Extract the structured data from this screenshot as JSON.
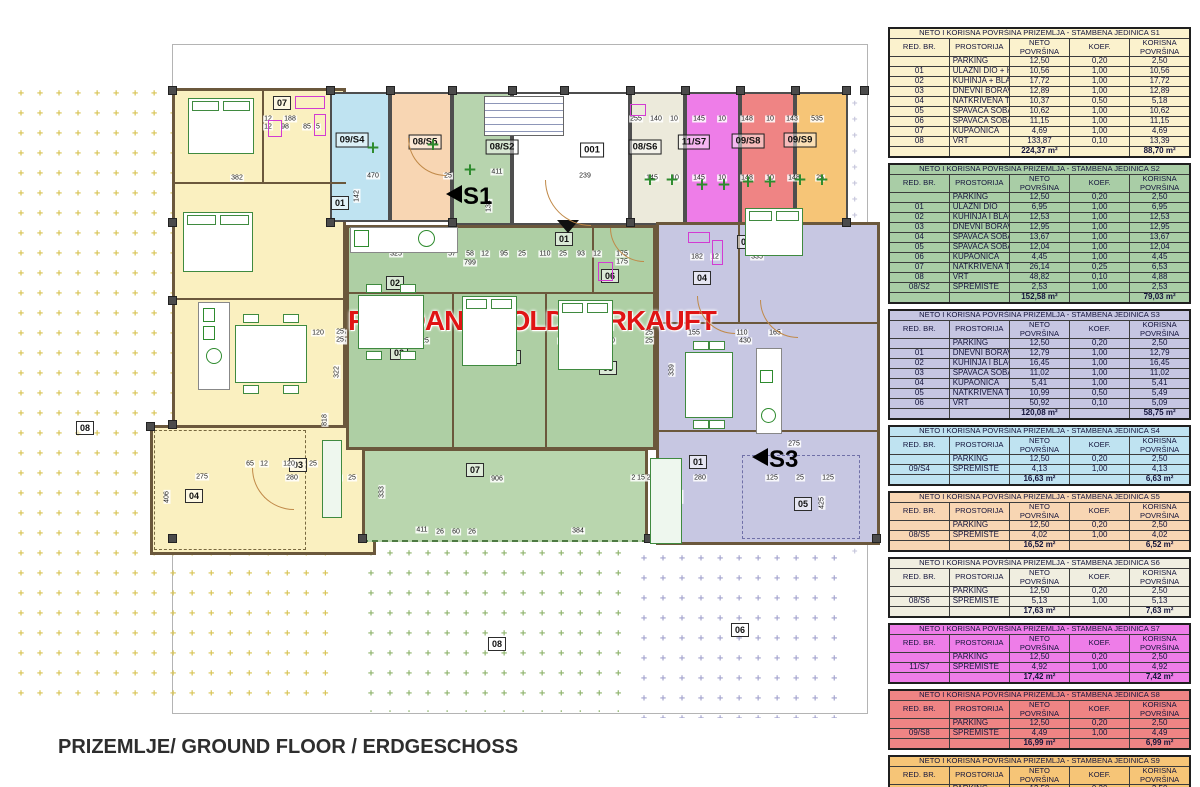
{
  "page": {
    "footer_title": "PRIZEMLJE/ GROUND FLOOR / ERDGESCHOSS"
  },
  "plan": {
    "sold_overlay": "PRODANO/SOLD/VERKAUFT",
    "sold_color": "#e01414",
    "hatch_char": "+",
    "entry_arrow_icon": "down-triangle",
    "section_arrows": [
      {
        "label": "S1",
        "x": 446,
        "y": 183
      },
      {
        "label": "S3",
        "x": 752,
        "y": 446
      }
    ],
    "unit_labels": [
      {
        "t": "09/S4",
        "x": 352,
        "y": 140
      },
      {
        "t": "08/S5",
        "x": 425,
        "y": 142
      },
      {
        "t": "08/S2",
        "x": 502,
        "y": 147
      },
      {
        "t": "001",
        "x": 592,
        "y": 150
      },
      {
        "t": "08/S6",
        "x": 645,
        "y": 147
      },
      {
        "t": "11/S7",
        "x": 694,
        "y": 142
      },
      {
        "t": "09/S8",
        "x": 748,
        "y": 141
      },
      {
        "t": "09/S9",
        "x": 800,
        "y": 140
      }
    ],
    "room_labels": [
      {
        "t": "06",
        "x": 225,
        "y": 143
      },
      {
        "t": "07",
        "x": 282,
        "y": 103
      },
      {
        "t": "05",
        "x": 222,
        "y": 240
      },
      {
        "t": "01",
        "x": 340,
        "y": 203
      },
      {
        "t": "02",
        "x": 270,
        "y": 365
      },
      {
        "t": "03",
        "x": 298,
        "y": 465
      },
      {
        "t": "04",
        "x": 194,
        "y": 496
      },
      {
        "t": "01",
        "x": 564,
        "y": 239
      },
      {
        "t": "02",
        "x": 395,
        "y": 283
      },
      {
        "t": "06",
        "x": 610,
        "y": 276
      },
      {
        "t": "03",
        "x": 399,
        "y": 353
      },
      {
        "t": "04",
        "x": 512,
        "y": 357
      },
      {
        "t": "05",
        "x": 608,
        "y": 368
      },
      {
        "t": "07",
        "x": 475,
        "y": 470
      },
      {
        "t": "03",
        "x": 746,
        "y": 242
      },
      {
        "t": "04",
        "x": 702,
        "y": 278
      },
      {
        "t": "02",
        "x": 712,
        "y": 377
      },
      {
        "t": "01",
        "x": 698,
        "y": 462
      },
      {
        "t": "05",
        "x": 803,
        "y": 504
      }
    ],
    "garden_labels": [
      {
        "t": "08",
        "x": 85,
        "y": 428
      },
      {
        "t": "08",
        "x": 497,
        "y": 644
      },
      {
        "t": "06",
        "x": 740,
        "y": 630
      }
    ],
    "dims": [
      {
        "t": "290",
        "x": 224,
        "y": 119
      },
      {
        "t": "290",
        "x": 224,
        "y": 127
      },
      {
        "t": "12",
        "x": 268,
        "y": 119
      },
      {
        "t": "188",
        "x": 290,
        "y": 119
      },
      {
        "t": "12",
        "x": 268,
        "y": 127
      },
      {
        "t": "98",
        "x": 285,
        "y": 127
      },
      {
        "t": "85",
        "x": 307,
        "y": 127
      },
      {
        "t": "5",
        "x": 318,
        "y": 127
      },
      {
        "t": "382",
        "x": 237,
        "y": 178
      },
      {
        "t": "317",
        "x": 228,
        "y": 255
      },
      {
        "t": "382",
        "x": 233,
        "y": 264
      },
      {
        "t": "310",
        "x": 272,
        "y": 333
      },
      {
        "t": "430",
        "x": 274,
        "y": 341
      },
      {
        "t": "120",
        "x": 318,
        "y": 333
      },
      {
        "t": "25",
        "x": 342,
        "y": 333
      },
      {
        "t": "25",
        "x": 342,
        "y": 341
      },
      {
        "t": "470",
        "x": 373,
        "y": 176
      },
      {
        "t": "25",
        "x": 448,
        "y": 176
      },
      {
        "t": "411",
        "x": 497,
        "y": 172
      },
      {
        "t": "239",
        "x": 585,
        "y": 176
      },
      {
        "t": "142",
        "x": 357,
        "y": 196,
        "r": 1
      },
      {
        "t": "134",
        "x": 489,
        "y": 206,
        "r": 1
      },
      {
        "t": "255",
        "x": 636,
        "y": 119
      },
      {
        "t": "140",
        "x": 656,
        "y": 119
      },
      {
        "t": "10",
        "x": 674,
        "y": 119
      },
      {
        "t": "145",
        "x": 699,
        "y": 119
      },
      {
        "t": "10",
        "x": 722,
        "y": 119
      },
      {
        "t": "148",
        "x": 747,
        "y": 119
      },
      {
        "t": "10",
        "x": 770,
        "y": 119
      },
      {
        "t": "143",
        "x": 792,
        "y": 119
      },
      {
        "t": "535",
        "x": 817,
        "y": 119
      },
      {
        "t": "145",
        "x": 652,
        "y": 178
      },
      {
        "t": "10",
        "x": 675,
        "y": 178
      },
      {
        "t": "145",
        "x": 699,
        "y": 178
      },
      {
        "t": "10",
        "x": 722,
        "y": 178
      },
      {
        "t": "148",
        "x": 747,
        "y": 178
      },
      {
        "t": "10",
        "x": 770,
        "y": 178
      },
      {
        "t": "148",
        "x": 794,
        "y": 178
      },
      {
        "t": "25",
        "x": 820,
        "y": 178
      },
      {
        "t": "325",
        "x": 396,
        "y": 254
      },
      {
        "t": "57",
        "x": 452,
        "y": 254
      },
      {
        "t": "58",
        "x": 470,
        "y": 254
      },
      {
        "t": "12",
        "x": 485,
        "y": 254
      },
      {
        "t": "799",
        "x": 470,
        "y": 263
      },
      {
        "t": "95",
        "x": 504,
        "y": 254
      },
      {
        "t": "25",
        "x": 522,
        "y": 254
      },
      {
        "t": "110",
        "x": 545,
        "y": 254
      },
      {
        "t": "25",
        "x": 563,
        "y": 254
      },
      {
        "t": "93",
        "x": 581,
        "y": 254
      },
      {
        "t": "12",
        "x": 597,
        "y": 254
      },
      {
        "t": "175",
        "x": 622,
        "y": 254
      },
      {
        "t": "175",
        "x": 622,
        "y": 262
      },
      {
        "t": "25",
        "x": 340,
        "y": 332
      },
      {
        "t": "25",
        "x": 340,
        "y": 340
      },
      {
        "t": "356",
        "x": 399,
        "y": 341
      },
      {
        "t": "25",
        "x": 425,
        "y": 341
      },
      {
        "t": "303",
        "x": 508,
        "y": 341
      },
      {
        "t": "12",
        "x": 562,
        "y": 341
      },
      {
        "t": "290",
        "x": 609,
        "y": 341
      },
      {
        "t": "25",
        "x": 649,
        "y": 333
      },
      {
        "t": "25",
        "x": 649,
        "y": 341
      },
      {
        "t": "322",
        "x": 337,
        "y": 372,
        "r": 1
      },
      {
        "t": "818",
        "x": 325,
        "y": 420,
        "r": 1
      },
      {
        "t": "333",
        "x": 382,
        "y": 492,
        "r": 1
      },
      {
        "t": "65",
        "x": 250,
        "y": 464
      },
      {
        "t": "12",
        "x": 264,
        "y": 464
      },
      {
        "t": "120",
        "x": 289,
        "y": 464
      },
      {
        "t": "25",
        "x": 313,
        "y": 464
      },
      {
        "t": "275",
        "x": 202,
        "y": 477
      },
      {
        "t": "280",
        "x": 292,
        "y": 478
      },
      {
        "t": "40",
        "x": 338,
        "y": 478
      },
      {
        "t": "25",
        "x": 352,
        "y": 478
      },
      {
        "t": "906",
        "x": 497,
        "y": 479
      },
      {
        "t": "411",
        "x": 422,
        "y": 530
      },
      {
        "t": "26",
        "x": 440,
        "y": 532
      },
      {
        "t": "60",
        "x": 456,
        "y": 532
      },
      {
        "t": "26",
        "x": 472,
        "y": 532
      },
      {
        "t": "384",
        "x": 578,
        "y": 531
      },
      {
        "t": "2 15 25",
        "x": 643,
        "y": 478
      },
      {
        "t": "275",
        "x": 794,
        "y": 444
      },
      {
        "t": "280",
        "x": 700,
        "y": 478
      },
      {
        "t": "125",
        "x": 772,
        "y": 478
      },
      {
        "t": "25",
        "x": 800,
        "y": 478
      },
      {
        "t": "125",
        "x": 828,
        "y": 478
      },
      {
        "t": "425",
        "x": 822,
        "y": 503,
        "r": 1
      },
      {
        "t": "400",
        "x": 680,
        "y": 497,
        "r": 1
      },
      {
        "t": "335",
        "x": 757,
        "y": 249
      },
      {
        "t": "335",
        "x": 757,
        "y": 257
      },
      {
        "t": "264",
        "x": 781,
        "y": 248,
        "r": 1
      },
      {
        "t": "182",
        "x": 697,
        "y": 257
      },
      {
        "t": "12",
        "x": 715,
        "y": 257
      },
      {
        "t": "155",
        "x": 694,
        "y": 333
      },
      {
        "t": "110",
        "x": 742,
        "y": 333
      },
      {
        "t": "165",
        "x": 775,
        "y": 333
      },
      {
        "t": "430",
        "x": 745,
        "y": 341
      },
      {
        "t": "339",
        "x": 672,
        "y": 370,
        "r": 1
      },
      {
        "t": "406",
        "x": 167,
        "y": 497,
        "r": 1
      }
    ]
  },
  "table_columns": [
    "RED. BR.",
    "PROSTORIJA",
    "NETO POVRŠINA",
    "KOEF.",
    "KORISNA POVRŠINA"
  ],
  "tables": [
    {
      "unit": "S1",
      "bg": "#fbf2cd",
      "title": "NETO I KORISNA POVRŠINA PRIZEMLJA - STAMBENA JEDINICA S1",
      "rows": [
        [
          "",
          "PARKING",
          "12,50",
          "0,20",
          "2,50"
        ],
        [
          "01",
          "ULAZNI DIO + HODNIK",
          "10,56",
          "1,00",
          "10,56"
        ],
        [
          "02",
          "KUHINJA + BLAGOVAONICA",
          "17,72",
          "1,00",
          "17,72"
        ],
        [
          "03",
          "DNEVNI BORAVAK",
          "12,89",
          "1,00",
          "12,89"
        ],
        [
          "04",
          "NATKRIVENA TERASA",
          "10,37",
          "0,50",
          "5,18"
        ],
        [
          "05",
          "SPAVAĆA SOBA",
          "10,62",
          "1,00",
          "10,62"
        ],
        [
          "06",
          "SPAVAĆA SOBA",
          "11,15",
          "1,00",
          "11,15"
        ],
        [
          "07",
          "KUPAONICA",
          "4,69",
          "1,00",
          "4,69"
        ],
        [
          "08",
          "VRT",
          "133,87",
          "0,10",
          "13,39"
        ]
      ],
      "total_neto": "224,37 m²",
      "total_korisna": "88,70 m²"
    },
    {
      "unit": "S2",
      "bg": "#a9cda6",
      "title": "NETO I KORISNA POVRŠINA PRIZEMLJA - STAMBENA JEDINICA S2",
      "rows": [
        [
          "",
          "PARKING",
          "12,50",
          "0,20",
          "2,50"
        ],
        [
          "01",
          "ULAZNI DIO",
          "6,95",
          "1,00",
          "6,95"
        ],
        [
          "02",
          "KUHINJA I BLAGOVAONICA",
          "12,53",
          "1,00",
          "12,53"
        ],
        [
          "03",
          "DNEVNI BORAVAK",
          "12,95",
          "1,00",
          "12,95"
        ],
        [
          "04",
          "SPAVAĆA SOBA",
          "13,67",
          "1,00",
          "13,67"
        ],
        [
          "05",
          "SPAVAĆA SOBA",
          "12,04",
          "1,00",
          "12,04"
        ],
        [
          "06",
          "KUPAONICA",
          "4,45",
          "1,00",
          "4,45"
        ],
        [
          "07",
          "NATKRIVENA TERASA",
          "26,14",
          "0,25",
          "6,53"
        ],
        [
          "08",
          "VRT",
          "48,82",
          "0,10",
          "4,88"
        ],
        [
          "08/S2",
          "SPREMIŠTE",
          "2,53",
          "1,00",
          "2,53"
        ]
      ],
      "total_neto": "152,58 m²",
      "total_korisna": "79,03 m²"
    },
    {
      "unit": "S3",
      "bg": "#c6c6e2",
      "title": "NETO I KORISNA POVRŠINA PRIZEMLJA - STAMBENA JEDINICA S3",
      "rows": [
        [
          "",
          "PARKING",
          "12,50",
          "0,20",
          "2,50"
        ],
        [
          "01",
          "DNEVNI BORAVAK",
          "12,79",
          "1,00",
          "12,79"
        ],
        [
          "02",
          "KUHINJA I BLAGOVAONICA",
          "16,45",
          "1,00",
          "16,45"
        ],
        [
          "03",
          "SPAVAĆA SOBA",
          "11,02",
          "1,00",
          "11,02"
        ],
        [
          "04",
          "KUPAONICA",
          "5,41",
          "1,00",
          "5,41"
        ],
        [
          "05",
          "NATKRIVENA TERASA",
          "10,99",
          "0,50",
          "5,49"
        ],
        [
          "06",
          "VRT",
          "50,92",
          "0,10",
          "5,09"
        ]
      ],
      "total_neto": "120,08 m²",
      "total_korisna": "58,75 m²"
    },
    {
      "unit": "S4",
      "bg": "#bfe3f1",
      "title": "NETO I KORISNA POVRŠINA PRIZEMLJA - STAMBENA JEDINICA S4",
      "rows": [
        [
          "",
          "PARKING",
          "12,50",
          "0,20",
          "2,50"
        ],
        [
          "09/S4",
          "SPREMIŠTE",
          "4,13",
          "1,00",
          "4,13"
        ]
      ],
      "total_neto": "16,63 m²",
      "total_korisna": "6,63 m²"
    },
    {
      "unit": "S5",
      "bg": "#f8d6b3",
      "title": "NETO I KORISNA POVRŠINA PRIZEMLJA - STAMBENA JEDINICA S5",
      "rows": [
        [
          "",
          "PARKING",
          "12,50",
          "0,20",
          "2,50"
        ],
        [
          "08/S5",
          "SPREMIŠTE",
          "4,02",
          "1,00",
          "4,02"
        ]
      ],
      "total_neto": "16,52 m²",
      "total_korisna": "6,52 m²"
    },
    {
      "unit": "S6",
      "bg": "#f0eee0",
      "title": "NETO I KORISNA POVRŠINA PRIZEMLJA - STAMBENA JEDINICA S6",
      "rows": [
        [
          "",
          "PARKING",
          "12,50",
          "0,20",
          "2,50"
        ],
        [
          "08/S6",
          "SPREMIŠTE",
          "5,13",
          "1,00",
          "5,13"
        ]
      ],
      "total_neto": "17,63 m²",
      "total_korisna": "7,63 m²"
    },
    {
      "unit": "S7",
      "bg": "#ee7de8",
      "title": "NETO I KORISNA POVRŠINA PRIZEMLJA - STAMBENA JEDINICA S7",
      "rows": [
        [
          "",
          "PARKING",
          "12,50",
          "0,20",
          "2,50"
        ],
        [
          "11/S7",
          "SPREMIŠTE",
          "4,92",
          "1,00",
          "4,92"
        ]
      ],
      "total_neto": "17,42 m²",
      "total_korisna": "7,42 m²"
    },
    {
      "unit": "S8",
      "bg": "#ef8484",
      "title": "NETO I KORISNA POVRŠINA PRIZEMLJA - STAMBENA JEDINICA S8",
      "rows": [
        [
          "",
          "PARKING",
          "12,50",
          "0,20",
          "2,50"
        ],
        [
          "09/S8",
          "SPREMIŠTE",
          "4,49",
          "1,00",
          "4,49"
        ]
      ],
      "total_neto": "16,99 m²",
      "total_korisna": "6,99 m²"
    },
    {
      "unit": "S9",
      "bg": "#f6c577",
      "title": "NETO I KORISNA POVRŠINA PRIZEMLJA - STAMBENA JEDINICA S9",
      "rows": [
        [
          "",
          "PARKING",
          "12,50",
          "0,20",
          "2,50"
        ],
        [
          "09/S9",
          "SPREMIŠTE",
          "4,51",
          "1,00",
          "4,51"
        ]
      ],
      "total_neto": "17,01 m²",
      "total_korisna": "7,01 m²"
    }
  ]
}
